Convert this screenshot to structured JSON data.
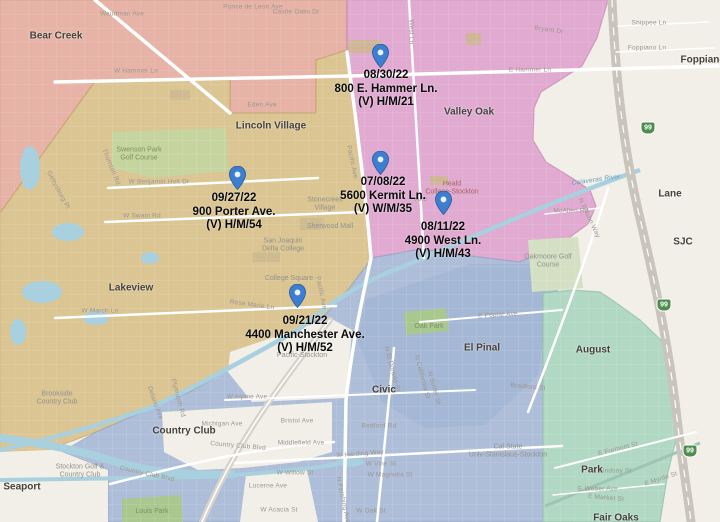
{
  "map": {
    "colors": {
      "bg": "#f2efe8",
      "salmon": "#e6b3a6",
      "salmon_border": "#cd8f80",
      "tan": "#dac593",
      "tan_border": "#c0a566",
      "magenta": "#e0aad1",
      "magenta_border": "#c584b2",
      "blue": "#aebed9",
      "blue_border": "#8fa6c8",
      "blue_inner": "#9db1d0",
      "teal": "#b0d8c2",
      "teal_border": "#8cbfa4",
      "green": "#c6d5a0",
      "green_dark": "#a9c890",
      "green_pale": "#d3e0c4",
      "building": "#cdb98f",
      "water": "#a8d0de",
      "canal": "#9ec4b6",
      "road": "#ffffff",
      "road_major": "#d7d3ca",
      "highway": "#c9c5bd",
      "pin": "#3e7ed0",
      "pin_border": "#2b5f9e",
      "shield": "#4f8c4f"
    },
    "markers": [
      {
        "date": "08/30/22",
        "address": "800 E. Hammer Ln.",
        "victim": "(V) H/M/21",
        "pin": {
          "x": 380,
          "y": 68
        },
        "label": {
          "x": 386,
          "y": 69
        }
      },
      {
        "date": "09/27/22",
        "address": "900 Porter Ave.",
        "victim": "(V) H/M/54",
        "pin": {
          "x": 237,
          "y": 190
        },
        "label": {
          "x": 234,
          "y": 192
        }
      },
      {
        "date": "07/08/22",
        "address": "5600 Kermit Ln.",
        "victim": "(V) W/M/35",
        "pin": {
          "x": 380,
          "y": 175
        },
        "label": {
          "x": 383,
          "y": 176
        }
      },
      {
        "date": "08/11/22",
        "address": "4900 West Ln.",
        "victim": "(V) H/M/43",
        "pin": {
          "x": 443,
          "y": 215
        },
        "label": {
          "x": 443,
          "y": 221
        }
      },
      {
        "date": "09/21/22",
        "address": "4400 Manchester Ave.",
        "victim": "(V) H/M/52",
        "pin": {
          "x": 297,
          "y": 308
        },
        "label": {
          "x": 305,
          "y": 315
        }
      }
    ],
    "place_labels": [
      {
        "text": "Bear Creek",
        "x": 56,
        "y": 36
      },
      {
        "text": "Lincoln Village",
        "x": 271,
        "y": 126
      },
      {
        "text": "Valley Oak",
        "x": 469,
        "y": 112
      },
      {
        "text": "Lakeview",
        "x": 131,
        "y": 288
      },
      {
        "text": "Country Club",
        "x": 184,
        "y": 431
      },
      {
        "text": "El Pinal",
        "x": 482,
        "y": 348
      },
      {
        "text": "August",
        "x": 593,
        "y": 350
      },
      {
        "text": "Civic",
        "x": 384,
        "y": 390
      },
      {
        "text": "Seaport",
        "x": 22,
        "y": 487
      },
      {
        "text": "Park",
        "x": 592,
        "y": 470
      },
      {
        "text": "Lane",
        "x": 670,
        "y": 194
      },
      {
        "text": "SJC",
        "x": 683,
        "y": 242
      },
      {
        "text": "Foppiano",
        "x": 703,
        "y": 60
      },
      {
        "text": "Fair Oaks",
        "x": 616,
        "y": 518
      }
    ],
    "poi_labels": [
      {
        "text": "Swenson Park\nGolf Course",
        "x": 139,
        "y": 155,
        "cls": "park"
      },
      {
        "text": "Brookside\nCountry Club",
        "x": 57,
        "y": 399
      },
      {
        "text": "Stockton Golf &\nCountry Club",
        "x": 80,
        "y": 472
      },
      {
        "text": "Oakmoore Golf\nCourse",
        "x": 548,
        "y": 262
      },
      {
        "text": "Oak Park",
        "x": 429,
        "y": 327,
        "cls": "park"
      },
      {
        "text": "Louis Park",
        "x": 152,
        "y": 512,
        "cls": "park"
      },
      {
        "text": "San Joaquin\nDelta College",
        "x": 283,
        "y": 246
      },
      {
        "text": "College Square",
        "x": 289,
        "y": 279
      },
      {
        "text": "Stonecreek\nVillage",
        "x": 325,
        "y": 205
      },
      {
        "text": "Sherwood Mall",
        "x": 330,
        "y": 227
      },
      {
        "text": "Cal State\nUniv-Stanislaus-Stockton",
        "x": 508,
        "y": 452
      },
      {
        "text": "Heald\nCollege-Stockton",
        "x": 452,
        "y": 189,
        "cls": "edu"
      },
      {
        "text": "Ake",
        "x": 421,
        "y": 200
      },
      {
        "text": "Pacific-Stockton",
        "x": 302,
        "y": 356
      }
    ],
    "street_labels": [
      {
        "text": "Waudman Ave",
        "x": 122,
        "y": 14
      },
      {
        "text": "Ponce de Leon Ave",
        "x": 253,
        "y": 7
      },
      {
        "text": "Castle Oaks Dr",
        "x": 296,
        "y": 12
      },
      {
        "text": "W Hammer Ln",
        "x": 136,
        "y": 71
      },
      {
        "text": "E Hammer Ln",
        "x": 530,
        "y": 70
      },
      {
        "text": "Bryant Dr",
        "x": 549,
        "y": 30,
        "rot": 8
      },
      {
        "text": "Shippee Ln",
        "x": 649,
        "y": 23
      },
      {
        "text": "Foppiano Ln",
        "x": 647,
        "y": 48
      },
      {
        "text": "West Ln",
        "x": 411,
        "y": 32,
        "rot": 90
      },
      {
        "text": "Eden Ave",
        "x": 262,
        "y": 105
      },
      {
        "text": "W Benjamin Holt Dr",
        "x": 159,
        "y": 182
      },
      {
        "text": "W Swain Rd",
        "x": 142,
        "y": 216
      },
      {
        "text": "W March Ln",
        "x": 100,
        "y": 311
      },
      {
        "text": "Gettysburg Pl",
        "x": 58,
        "y": 190,
        "rot": 62
      },
      {
        "text": "Thornton Rd",
        "x": 111,
        "y": 167,
        "rot": 68
      },
      {
        "text": "Pacific Ave",
        "x": 352,
        "y": 162,
        "rot": 78
      },
      {
        "text": "Pacific Ave",
        "x": 321,
        "y": 293,
        "rot": 78
      },
      {
        "text": "Rose Marie Ln",
        "x": 252,
        "y": 305,
        "rot": 8
      },
      {
        "text": "McAllen Rd",
        "x": 571,
        "y": 211
      },
      {
        "text": "N Wilson Way",
        "x": 589,
        "y": 218,
        "rot": 65
      },
      {
        "text": "E Poplar Ave",
        "x": 498,
        "y": 315,
        "rot": -3
      },
      {
        "text": "N El Dorado St",
        "x": 392,
        "y": 369,
        "rot": 75
      },
      {
        "text": "N California St",
        "x": 422,
        "y": 377,
        "rot": 75
      },
      {
        "text": "N Sutter St",
        "x": 434,
        "y": 388,
        "rot": 75
      },
      {
        "text": "Bradford St",
        "x": 528,
        "y": 387,
        "rot": 5
      },
      {
        "text": "Michigan Ave",
        "x": 222,
        "y": 424
      },
      {
        "text": "Bristol Ave",
        "x": 297,
        "y": 421
      },
      {
        "text": "Country Club Blvd",
        "x": 238,
        "y": 446,
        "rot": 5
      },
      {
        "text": "Country Club Blvd",
        "x": 147,
        "y": 474,
        "rot": 12
      },
      {
        "text": "Middlefield Ave",
        "x": 301,
        "y": 443
      },
      {
        "text": "W Harding Way",
        "x": 360,
        "y": 454,
        "rot": -4
      },
      {
        "text": "W Vine St",
        "x": 381,
        "y": 464
      },
      {
        "text": "W Magnolia St",
        "x": 390,
        "y": 475
      },
      {
        "text": "W Willow St",
        "x": 295,
        "y": 473
      },
      {
        "text": "Lucerne Ave",
        "x": 268,
        "y": 486
      },
      {
        "text": "W Acacia St",
        "x": 279,
        "y": 510
      },
      {
        "text": "W Oak St",
        "x": 371,
        "y": 511
      },
      {
        "text": "Bedford Rd",
        "x": 379,
        "y": 426
      },
      {
        "text": "N Pershing Ave",
        "x": 343,
        "y": 500,
        "rot": 78
      },
      {
        "text": "W Alpine Ave",
        "x": 247,
        "y": 397
      },
      {
        "text": "Delano Ave",
        "x": 155,
        "y": 403,
        "rot": 70
      },
      {
        "text": "Plymouth Rd",
        "x": 178,
        "y": 398,
        "rot": 75
      },
      {
        "text": "E Fremont St",
        "x": 618,
        "y": 449,
        "rot": -14
      },
      {
        "text": "E Lindsay St",
        "x": 612,
        "y": 471
      },
      {
        "text": "E Weber Ave",
        "x": 598,
        "y": 489
      },
      {
        "text": "E Myrtle St",
        "x": 661,
        "y": 479,
        "rot": -18
      },
      {
        "text": "E Market St",
        "x": 606,
        "y": 498,
        "rot": 5
      },
      {
        "text": "Calaveras River",
        "x": 596,
        "y": 180,
        "rot": -8,
        "cls": "water-label"
      }
    ],
    "highway_shields": [
      {
        "label": "99",
        "x": 648,
        "y": 128
      },
      {
        "label": "99",
        "x": 664,
        "y": 305
      },
      {
        "label": "99",
        "x": 690,
        "y": 451
      }
    ]
  }
}
